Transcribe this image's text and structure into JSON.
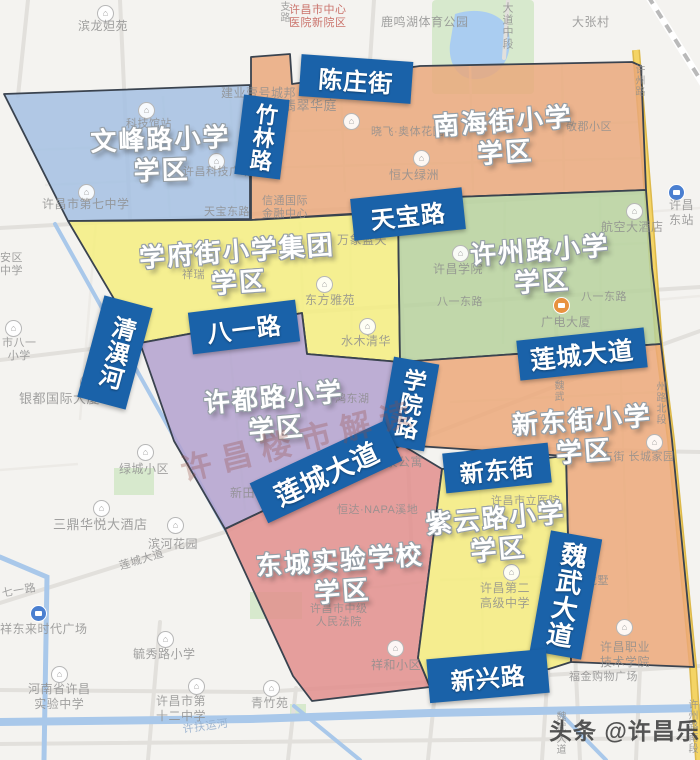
{
  "map": {
    "region_border": "#3a434f",
    "label_box_color": "#1a62a9",
    "districts": [
      {
        "name": "文峰路小学",
        "name2": "学区",
        "color": "#a3c0e2",
        "polygon": [
          [
            4,
            94
          ],
          [
            250,
            85
          ],
          [
            250,
            219
          ],
          [
            68,
            221
          ]
        ],
        "label": {
          "x": 161,
          "y": 155,
          "rotate": -2
        }
      },
      {
        "name": "南海街小学",
        "name2": "学区",
        "color": "#eaa87b",
        "polygon": [
          [
            251,
            86
          ],
          [
            251,
            57
          ],
          [
            290,
            54
          ],
          [
            292,
            84
          ],
          [
            420,
            66
          ],
          [
            632,
            62
          ],
          [
            641,
            66
          ],
          [
            646,
            190
          ],
          [
            455,
            197
          ],
          [
            398,
            211
          ],
          [
            251,
            220
          ]
        ],
        "label": {
          "x": 504,
          "y": 137,
          "rotate": -4
        }
      },
      {
        "name": "学府街小学集团",
        "name2": "学区",
        "color": "#f4ee7e",
        "polygon": [
          [
            68,
            221
          ],
          [
            251,
            220
          ],
          [
            398,
            212
          ],
          [
            400,
            362
          ],
          [
            307,
            354
          ],
          [
            302,
            313
          ],
          [
            140,
            343
          ]
        ],
        "label": {
          "x": 238,
          "y": 267,
          "rotate": -4
        }
      },
      {
        "name": "许州路小学",
        "name2": "学区",
        "color": "#b6d29c",
        "polygon": [
          [
            398,
            211
          ],
          [
            455,
            197
          ],
          [
            646,
            190
          ],
          [
            652,
            268
          ],
          [
            661,
            344
          ],
          [
            400,
            362
          ]
        ],
        "label": {
          "x": 541,
          "y": 266,
          "rotate": -4
        }
      },
      {
        "name": "许都路小学",
        "name2": "学区",
        "color": "#b2a1ce",
        "polygon": [
          [
            140,
            343
          ],
          [
            302,
            313
          ],
          [
            307,
            354
          ],
          [
            400,
            362
          ],
          [
            402,
            445
          ],
          [
            225,
            529
          ],
          [
            174,
            441
          ]
        ],
        "label": {
          "x": 275,
          "y": 413,
          "rotate": -5
        }
      },
      {
        "name": "新东街小学",
        "name2": "学区",
        "color": "#eca878",
        "polygon": [
          [
            400,
            362
          ],
          [
            661,
            344
          ],
          [
            672,
            440
          ],
          [
            694,
            667
          ],
          [
            571,
            662
          ],
          [
            566,
            456
          ],
          [
            402,
            445
          ],
          [
            400,
            366
          ]
        ],
        "label": {
          "x": 583,
          "y": 436,
          "rotate": -4
        }
      },
      {
        "name": "东城实验学校",
        "name2": "学区",
        "color": "#e18e8c",
        "polygon": [
          [
            225,
            529
          ],
          [
            402,
            445
          ],
          [
            442,
            469
          ],
          [
            418,
            658
          ],
          [
            430,
            687
          ],
          [
            312,
            701
          ],
          [
            293,
            676
          ]
        ],
        "label": {
          "x": 341,
          "y": 576,
          "rotate": -4
        }
      },
      {
        "name": "紫云路小学",
        "name2": "学区",
        "color": "#f4ec7c",
        "polygon": [
          [
            442,
            469
          ],
          [
            566,
            456
          ],
          [
            571,
            662
          ],
          [
            549,
            669
          ],
          [
            430,
            687
          ],
          [
            418,
            658
          ]
        ],
        "label": {
          "x": 497,
          "y": 534,
          "rotate": -5
        }
      }
    ],
    "road_labels": [
      {
        "text": "陈庄街",
        "x": 300,
        "y": 58,
        "w": 112,
        "h": 42,
        "rotate": 4,
        "vertical": false,
        "size": 24
      },
      {
        "text": "竹林路",
        "x": 239,
        "y": 97,
        "w": 46,
        "h": 80,
        "rotate": 7,
        "vertical": true,
        "size": 22
      },
      {
        "text": "天宝路",
        "x": 352,
        "y": 193,
        "w": 112,
        "h": 42,
        "rotate": -6,
        "vertical": false,
        "size": 24
      },
      {
        "text": "八一路",
        "x": 190,
        "y": 306,
        "w": 108,
        "h": 42,
        "rotate": -7,
        "vertical": false,
        "size": 24
      },
      {
        "text": "清潩河",
        "x": 90,
        "y": 300,
        "w": 50,
        "h": 105,
        "rotate": 15,
        "vertical": true,
        "size": 24
      },
      {
        "text": "莲城大道",
        "x": 518,
        "y": 334,
        "w": 128,
        "h": 40,
        "rotate": -6,
        "vertical": false,
        "size": 25
      },
      {
        "text": "学院路",
        "x": 386,
        "y": 360,
        "w": 46,
        "h": 88,
        "rotate": 10,
        "vertical": true,
        "size": 23
      },
      {
        "text": "新东街",
        "x": 444,
        "y": 448,
        "w": 106,
        "h": 40,
        "rotate": -6,
        "vertical": false,
        "size": 24
      },
      {
        "text": "莲城大道",
        "x": 252,
        "y": 450,
        "w": 148,
        "h": 44,
        "rotate": -25,
        "vertical": false,
        "size": 27
      },
      {
        "text": "魏武大道",
        "x": 540,
        "y": 534,
        "w": 52,
        "h": 122,
        "rotate": 10,
        "vertical": true,
        "size": 26
      },
      {
        "text": "新兴路",
        "x": 428,
        "y": 654,
        "w": 120,
        "h": 44,
        "rotate": -5,
        "vertical": false,
        "size": 24
      }
    ],
    "poi_labels": [
      {
        "text": "滨龙妲苑",
        "x": 78,
        "y": 19,
        "size": 12
      },
      {
        "text": "许昌市中心\n医院新院区",
        "x": 289,
        "y": 4,
        "size": 11,
        "color": "#c2574f"
      },
      {
        "text": "鹿鸣湖体育公园",
        "x": 381,
        "y": 15,
        "size": 12
      },
      {
        "text": "大张村",
        "x": 572,
        "y": 15,
        "size": 12
      },
      {
        "text": "大道中段",
        "x": 501,
        "y": 2,
        "size": 11,
        "vertical": true
      },
      {
        "text": "支路",
        "x": 278,
        "y": 1,
        "size": 10,
        "vertical": true
      },
      {
        "text": "许昌市第七中学",
        "x": 42,
        "y": 197,
        "size": 12
      },
      {
        "text": "科技馆站",
        "x": 126,
        "y": 118,
        "size": 11
      },
      {
        "text": "许昌科技广场",
        "x": 183,
        "y": 166,
        "size": 11
      },
      {
        "text": "建业壹号城邦",
        "x": 221,
        "y": 86,
        "size": 12
      },
      {
        "text": "翡翠华庭",
        "x": 283,
        "y": 98,
        "size": 13
      },
      {
        "text": "晓飞·奥体花园",
        "x": 371,
        "y": 126,
        "size": 11
      },
      {
        "text": "敬郡小区",
        "x": 566,
        "y": 121,
        "size": 11
      },
      {
        "text": "恒大绿洲",
        "x": 389,
        "y": 168,
        "size": 12
      },
      {
        "text": "天宝东路",
        "x": 204,
        "y": 206,
        "size": 11
      },
      {
        "text": "信通国际\n金融中心",
        "x": 262,
        "y": 195,
        "size": 11
      },
      {
        "text": "许昌东站",
        "x": 663,
        "y": 198,
        "size": 12
      },
      {
        "text": "航空大酒店",
        "x": 601,
        "y": 220,
        "size": 12
      },
      {
        "text": "万象蓝天",
        "x": 337,
        "y": 233,
        "size": 12
      },
      {
        "text": "安区\n中学",
        "x": 0,
        "y": 252,
        "size": 11
      },
      {
        "text": "祥瑞",
        "x": 182,
        "y": 269,
        "size": 11
      },
      {
        "text": "东方雅苑",
        "x": 305,
        "y": 293,
        "size": 12
      },
      {
        "text": "许昌学院",
        "x": 433,
        "y": 262,
        "size": 12
      },
      {
        "text": "八一东路",
        "x": 437,
        "y": 296,
        "size": 11
      },
      {
        "text": "八一东路",
        "x": 581,
        "y": 291,
        "size": 11
      },
      {
        "text": "广电大厦",
        "x": 541,
        "y": 315,
        "size": 12
      },
      {
        "text": "水木清华",
        "x": 341,
        "y": 334,
        "size": 12
      },
      {
        "text": "市八一\n小学",
        "x": 2,
        "y": 337,
        "size": 11
      },
      {
        "text": "银都国际大厦",
        "x": 19,
        "y": 391,
        "size": 13
      },
      {
        "text": "鸿东湖",
        "x": 335,
        "y": 393,
        "size": 11
      },
      {
        "text": "许州路",
        "x": 633,
        "y": 64,
        "size": 10,
        "vertical": true
      },
      {
        "text": "新田3",
        "x": 230,
        "y": 486,
        "size": 12
      },
      {
        "text": "温泉公寓",
        "x": 373,
        "y": 455,
        "size": 12
      },
      {
        "text": "恒达·NAPA溪地",
        "x": 337,
        "y": 504,
        "size": 11
      },
      {
        "text": "许昌市立医院",
        "x": 491,
        "y": 495,
        "size": 11
      },
      {
        "text": "东街 长城家园",
        "x": 602,
        "y": 451,
        "size": 11
      },
      {
        "text": "魏武",
        "x": 552,
        "y": 380,
        "size": 10,
        "vertical": true
      },
      {
        "text": "州路北段",
        "x": 654,
        "y": 381,
        "size": 10,
        "vertical": true
      },
      {
        "text": "绿城小区",
        "x": 119,
        "y": 462,
        "size": 12
      },
      {
        "text": "三鼎华悦大酒店",
        "x": 53,
        "y": 517,
        "size": 13
      },
      {
        "text": "滨河花园",
        "x": 148,
        "y": 537,
        "size": 12
      },
      {
        "text": "莲城大道",
        "x": 118,
        "y": 561,
        "size": 11,
        "rotate": -17
      },
      {
        "text": "七一路",
        "x": 1,
        "y": 588,
        "size": 11,
        "rotate": -10
      },
      {
        "text": "祥东来时代广场",
        "x": 0,
        "y": 622,
        "size": 12
      },
      {
        "text": "毓秀路小学",
        "x": 133,
        "y": 647,
        "size": 12
      },
      {
        "text": "河南省许昌\n实验中学",
        "x": 28,
        "y": 682,
        "size": 12
      },
      {
        "text": "许昌市第\n十二中学",
        "x": 156,
        "y": 694,
        "size": 12
      },
      {
        "text": "青竹苑",
        "x": 251,
        "y": 696,
        "size": 12
      },
      {
        "text": "许扶运河",
        "x": 182,
        "y": 724,
        "size": 11,
        "rotate": -8,
        "color": "#8fabcb"
      },
      {
        "text": "许昌市中级\n人民法院",
        "x": 310,
        "y": 603,
        "size": 11
      },
      {
        "text": "祥和小区",
        "x": 371,
        "y": 658,
        "size": 12
      },
      {
        "text": "许昌第二\n高级中学",
        "x": 480,
        "y": 581,
        "size": 12
      },
      {
        "text": "龙墅",
        "x": 586,
        "y": 575,
        "size": 11
      },
      {
        "text": "许昌职业\n技术学院",
        "x": 600,
        "y": 640,
        "size": 12
      },
      {
        "text": "福金购物广场",
        "x": 569,
        "y": 671,
        "size": 11
      },
      {
        "text": "魏武大道",
        "x": 554,
        "y": 711,
        "size": 10,
        "vertical": true
      },
      {
        "text": "许州路南段",
        "x": 686,
        "y": 699,
        "size": 10,
        "vertical": true
      }
    ],
    "icons": [
      {
        "name": "poi-house-icon",
        "x": 97,
        "y": 5
      },
      {
        "name": "poi-house-icon",
        "x": 138,
        "y": 102
      },
      {
        "name": "poi-house-icon",
        "x": 208,
        "y": 153
      },
      {
        "name": "poi-house-icon",
        "x": 343,
        "y": 113
      },
      {
        "name": "poi-house-icon",
        "x": 413,
        "y": 150
      },
      {
        "name": "poi-house-icon",
        "x": 78,
        "y": 184
      },
      {
        "name": "poi-house-icon",
        "x": 316,
        "y": 276
      },
      {
        "name": "poi-house-icon",
        "x": 359,
        "y": 318
      },
      {
        "name": "poi-house-icon",
        "x": 452,
        "y": 245
      },
      {
        "name": "poi-house-icon",
        "x": 626,
        "y": 203
      },
      {
        "name": "poi-house-icon",
        "x": 5,
        "y": 320
      },
      {
        "name": "poi-house-icon",
        "x": 80,
        "y": 374
      },
      {
        "name": "poi-house-icon",
        "x": 137,
        "y": 444
      },
      {
        "name": "poi-house-icon",
        "x": 93,
        "y": 500
      },
      {
        "name": "poi-house-icon",
        "x": 167,
        "y": 517
      },
      {
        "name": "poi-house-icon",
        "x": 157,
        "y": 631
      },
      {
        "name": "poi-house-icon",
        "x": 51,
        "y": 666
      },
      {
        "name": "poi-house-icon",
        "x": 188,
        "y": 678
      },
      {
        "name": "poi-house-icon",
        "x": 263,
        "y": 680
      },
      {
        "name": "poi-house-icon",
        "x": 387,
        "y": 640
      },
      {
        "name": "poi-house-icon",
        "x": 503,
        "y": 564
      },
      {
        "name": "poi-house-icon",
        "x": 616,
        "y": 619
      },
      {
        "name": "poi-house-icon",
        "x": 646,
        "y": 434
      },
      {
        "name": "bus-stop-icon",
        "x": 30,
        "y": 605
      },
      {
        "name": "bus-stop-icon",
        "x": 668,
        "y": 184
      },
      {
        "name": "bus-stop-orange-icon",
        "x": 553,
        "y": 297
      }
    ],
    "watermarks": {
      "map_watermark": "许昌楼市解读",
      "credit": "头条 @许昌乐居"
    }
  }
}
